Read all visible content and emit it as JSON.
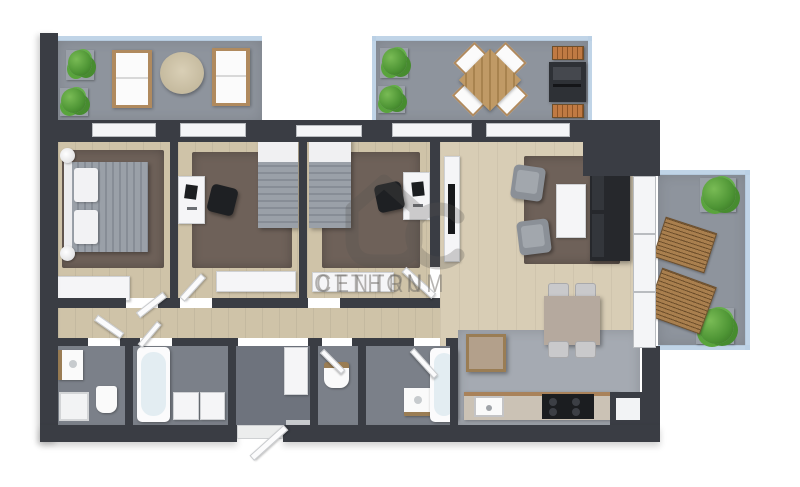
{
  "watermark": {
    "brand_line1": "OTTHON",
    "brand_line2": "CENTRUM",
    "logo": "otthon-centrum-house-logo"
  },
  "colors": {
    "wall": "#3a3d44",
    "wood-floor": "#cfc3a8",
    "wood-floor-light": "#d8cdb5",
    "rug": "#6e6159",
    "balcony-floor": "#8e949d",
    "glass": "#b9cfe4",
    "bath-floor": "#7b8089",
    "entry-floor": "#6e737d",
    "kitchen-floor": "#a5aab2",
    "plant": "#4d9434",
    "planter": "#9aa0a8",
    "wood-furniture": "#b08a5e",
    "dark-furniture": "#26282c",
    "white-furniture": "#f5f5f7",
    "duvet": "#9aa0a8",
    "counter": "#cbc2b5",
    "watermark": "#6f6c67"
  }
}
